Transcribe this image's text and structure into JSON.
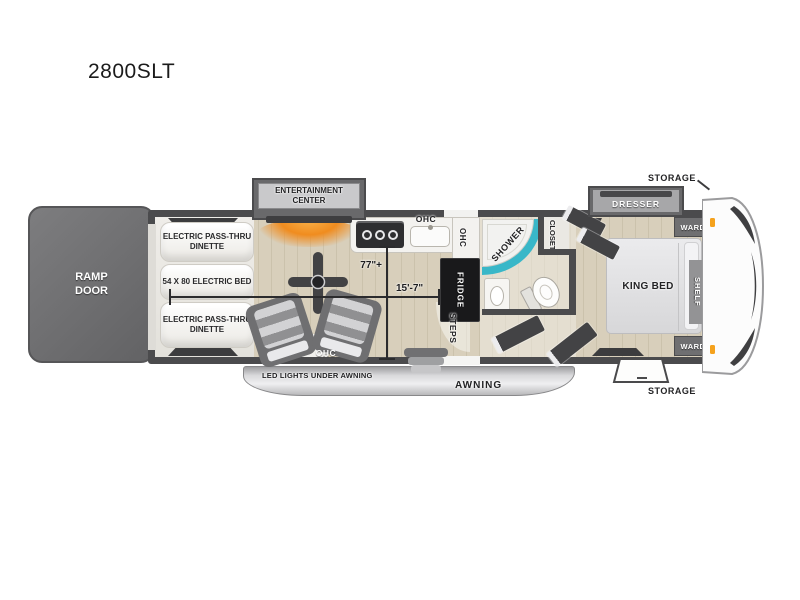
{
  "title": "2800SLT",
  "exterior": {
    "ramp_door": "RAMP DOOR",
    "led_lights": "LED LIGHTS UNDER AWNING",
    "awning": "AWNING",
    "storage_top": "STORAGE",
    "storage_bottom": "STORAGE"
  },
  "garage": {
    "dinette_front": "ELECTRIC PASS-THRU DINETTE",
    "electric_bed": "54 X 80 ELECTRIC BED",
    "dinette_rear": "ELECTRIC PASS-THRU DINETTE"
  },
  "living": {
    "entertainment_center": "ENTERTAINMENT CENTER",
    "ohc": "OHC"
  },
  "kitchen": {
    "ohc_top": "OHC",
    "ohc_side": "OHC",
    "fridge": "FRIDGE"
  },
  "bath": {
    "shower": "SHOWER",
    "closet": "CLOSET"
  },
  "entry": {
    "steps": "STEPS"
  },
  "bedroom": {
    "dresser": "DRESSER",
    "wardrobe_top": "WARD",
    "king_bed": "KING BED",
    "shelf": "SHELF",
    "wardrobe_bottom": "WARD"
  },
  "dimensions": {
    "interior_width": "77\"+",
    "garage_length": "15'-7\""
  },
  "colors": {
    "wall": "#4b4b4d",
    "shower_accent": "#39b7c8",
    "fireplace_glow": "#f08c1f",
    "marker_light": "#f5a21d",
    "ramp_door": "#6e6e70"
  }
}
